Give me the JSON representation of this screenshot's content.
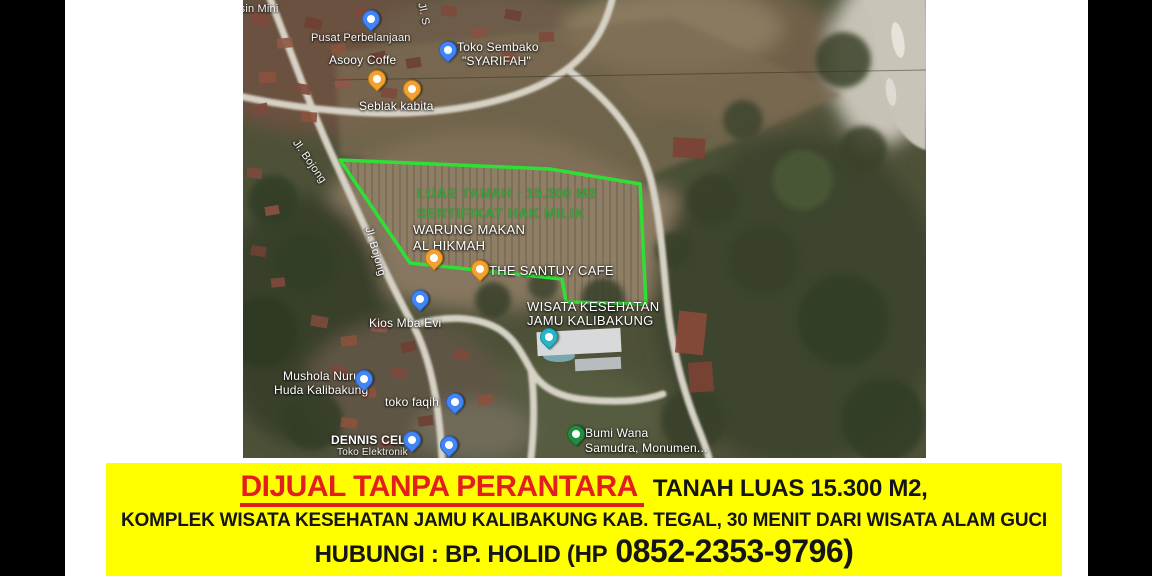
{
  "banner": {
    "background_color": "#ffff00",
    "headline_red": "DIJUAL TANPA PERANTARA",
    "headline_red_color": "#e31e1e",
    "headline_black": "TANAH LUAS 15.300 M2,",
    "line2": "KOMPLEK WISATA KESEHATAN JAMU KALIBAKUNG KAB. TEGAL, 30 MENIT DARI WISATA ALAM GUCI",
    "line3_prefix": "HUBUNGI : BP. HOLID (HP",
    "line3_phone": "0852-2353-9796)"
  },
  "map": {
    "type": "google-maps-satellite-screenshot",
    "plot_outline_color": "#30df35",
    "overlay": {
      "luas_tanah": "LUAS TANAH : 15.300 M2",
      "sertifikat": "SERTIFIKAT HAK MILIK",
      "text_color": "#3aa33c"
    },
    "labels": [
      {
        "text": "ensin Mini"
      },
      {
        "text": "Jl. S"
      },
      {
        "text": "Pusat Perbelanjaan"
      },
      {
        "text": "Asooy Coffe"
      },
      {
        "text": "Toko Sembako"
      },
      {
        "text": "\"SYARIFAH\""
      },
      {
        "text": "Seblak kabita"
      },
      {
        "text": "Jl. Bojong"
      },
      {
        "text": "Jl. Bojong"
      },
      {
        "text": "WARUNG MAKAN"
      },
      {
        "text": "AL HIKMAH"
      },
      {
        "text": "THE SANTUY CAFE"
      },
      {
        "text": "Kios Mba Evi"
      },
      {
        "text": "WISATA KESEHATAN"
      },
      {
        "text": "JAMU KALIBAKUNG"
      },
      {
        "text": "Mushola Nurul"
      },
      {
        "text": "Huda Kalibakung"
      },
      {
        "text": "toko faqih"
      },
      {
        "text": "DENNIS CELL"
      },
      {
        "text": "Toko Elektronik"
      },
      {
        "text": "Bumi Wana"
      },
      {
        "text": "Samudra, Monumen..."
      }
    ],
    "markers": [
      {
        "icon": "shopping-bag-pin",
        "color": "#4285f4",
        "place": "Pusat Perbelanjaan"
      },
      {
        "icon": "store-pin",
        "color": "#4285f4",
        "place": "Toko Sembako \"SYARIFAH\""
      },
      {
        "icon": "coffee-pin",
        "color": "#f2a230",
        "place": "Asooy Coffe"
      },
      {
        "icon": "coffee-pin",
        "color": "#f2a230",
        "place": "Seblak kabita"
      },
      {
        "icon": "restaurant-pin",
        "color": "#f2a230",
        "place": "Warung Makan Al Hikmah"
      },
      {
        "icon": "cafe-pin",
        "color": "#f2a230",
        "place": "The Santuy Cafe"
      },
      {
        "icon": "store-pin",
        "color": "#4285f4",
        "place": "Kios Mba Evi"
      },
      {
        "icon": "mosque-pin",
        "color": "#4285f4",
        "place": "Mushola Nurul Huda Kalibakung"
      },
      {
        "icon": "store-pin",
        "color": "#4285f4",
        "place": "toko faqih"
      },
      {
        "icon": "store-pin",
        "color": "#4285f4",
        "place": "Dennis Cell Toko Elektronik"
      },
      {
        "icon": "store-pin",
        "color": "#4285f4",
        "place": "unnamed"
      },
      {
        "icon": "spa-pin",
        "color": "#29b5c8",
        "place": "Wisata Kesehatan Jamu Kalibakung"
      },
      {
        "icon": "park-tree-pin",
        "color": "#1e8e3e",
        "place": "Bumi Wana Samudra, Monumen..."
      }
    ]
  }
}
